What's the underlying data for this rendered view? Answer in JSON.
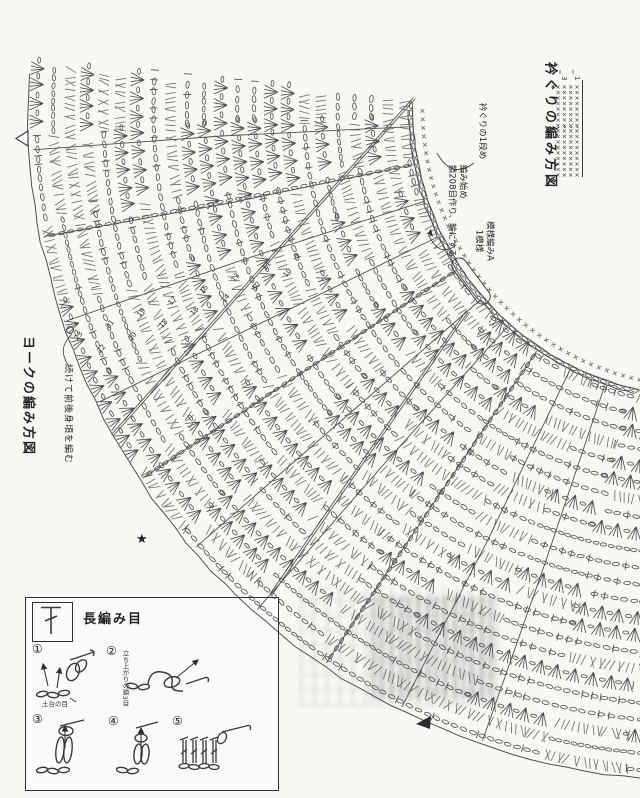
{
  "colors": {
    "ink": "#3a3a3a",
    "background": "#f8f7f4"
  },
  "titles": {
    "neckline_diagram": "衿ぐりの編み方図",
    "yoke_diagram": "ヨークの編み方図"
  },
  "annotations": {
    "neckline_row1": "衿ぐりの1段め",
    "start_line1": "編み始め",
    "start_line2": "鎖208目作り、輪にする",
    "pattern_line1": "模様編みA",
    "pattern_line2": "1模様",
    "continue_body": "続けて前後身頃を編む"
  },
  "neckline_grid": {
    "symbol": "×",
    "cols": 4,
    "rows": 17,
    "row_labels": [
      "3",
      "1"
    ]
  },
  "row_numbers": [
    "9",
    "10",
    "11",
    "12",
    "13",
    "14",
    "15",
    "16",
    "17",
    "18",
    "19",
    "20",
    "21",
    "22",
    "23"
  ],
  "markers": [
    {
      "name": "open-triangle-marker"
    },
    {
      "name": "star-marker",
      "glyph": "★"
    },
    {
      "name": "filled-triangle-marker"
    }
  ],
  "legend": {
    "title": "長編み目",
    "symbol_name": "double-crochet-symbol",
    "steps": [
      "①",
      "②",
      "③",
      "④",
      "⑤"
    ],
    "standing_label": "立ち上がりの鎖3目",
    "base_label": "土台の目"
  },
  "fan": {
    "cx": 700,
    "cy": 109,
    "r_inner": 287,
    "r_outer": 672,
    "a_start": 95,
    "a_end": 183.5,
    "rows": 23,
    "row_height": 16.74,
    "seed": 7,
    "spoke_degs": [
      176.5,
      169,
      161.5,
      154,
      146.5,
      139,
      131.5,
      124,
      116.5,
      109
    ],
    "chain_spoke_degs": [
      169,
      146.5,
      124
    ],
    "chords": [
      [
        415,
        99,
        113,
        436
      ],
      [
        468,
        312,
        272,
        595
      ]
    ],
    "number_seam_deg_odd": 159.6,
    "number_seam_deg_even": 157.8
  }
}
